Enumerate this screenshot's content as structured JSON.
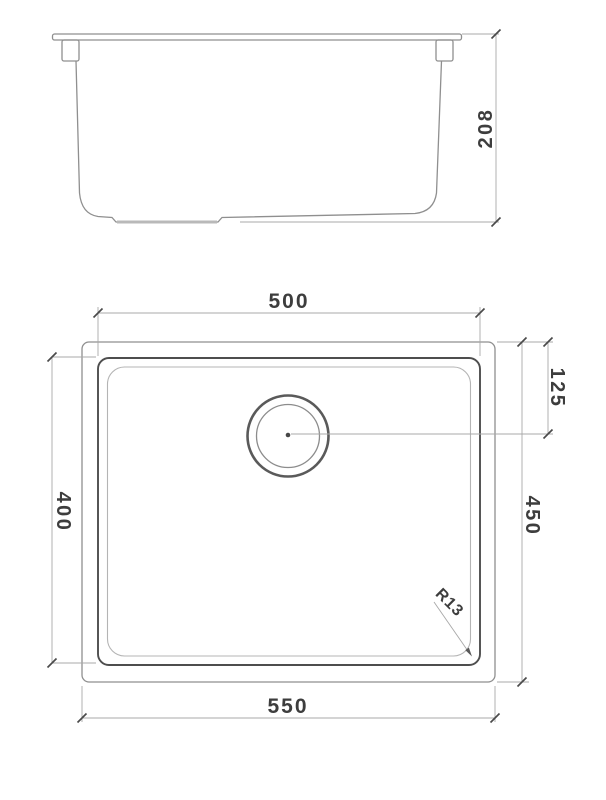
{
  "drawing": {
    "side_view": {
      "height_dim": "208"
    },
    "plan_view": {
      "inner_width_dim": "500",
      "outer_width_dim": "550",
      "inner_depth_dim": "400",
      "outer_depth_dim": "450",
      "drain_offset_dim": "125",
      "corner_radius_dim": "R13"
    }
  },
  "colors": {
    "outline": "#8f8f8f",
    "dark_line": "#4e4e4e",
    "light_line": "#b4b4b4",
    "dim_line": "#a8a8a8",
    "tick": "#4a4a4a",
    "text": "#3d3d3d",
    "background": "#ffffff"
  }
}
